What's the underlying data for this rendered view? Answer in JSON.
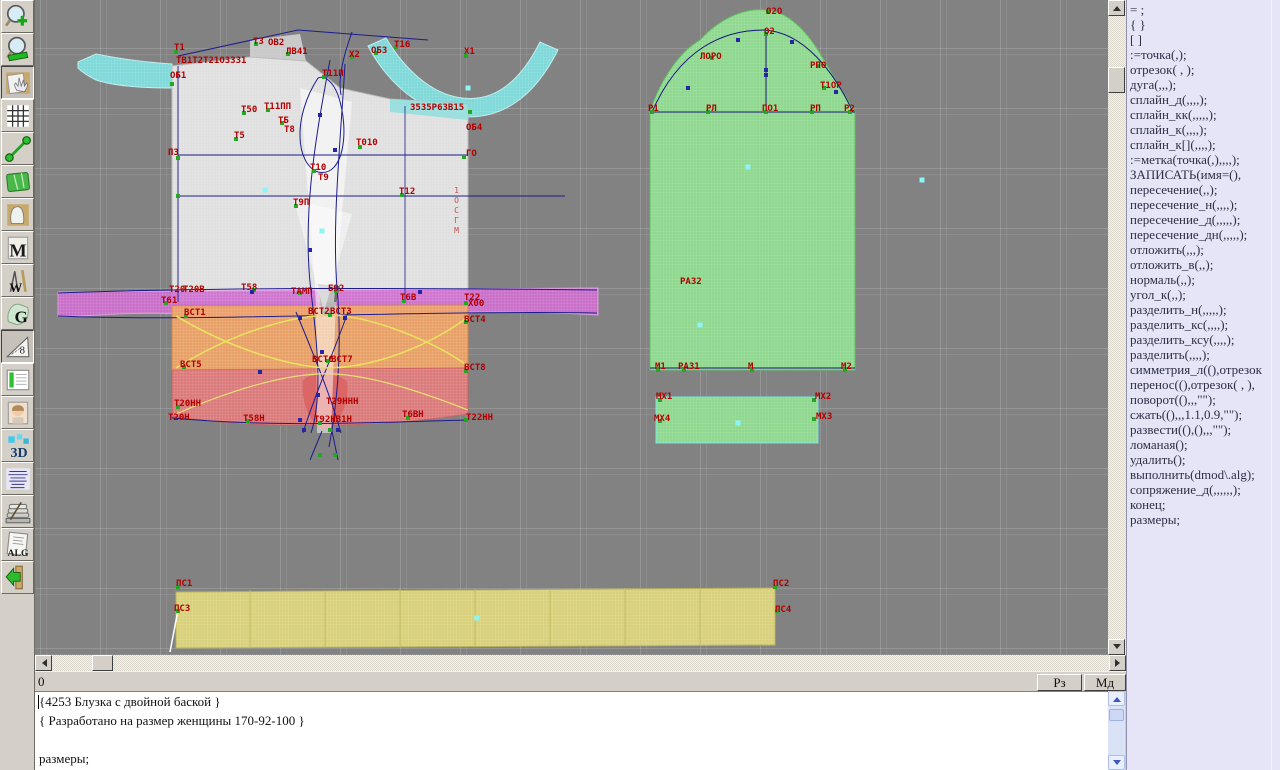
{
  "status": {
    "left": "0",
    "buttons": [
      "Рз",
      "Мд"
    ]
  },
  "editor": {
    "lines": [
      "{4253 Блузка с двойной баской }",
      "{ Разработано на размер женщины 170-92-100 }",
      "",
      "размеры;"
    ]
  },
  "command_panel": {
    "bg": "#e5e5f7",
    "items": [
      "= ;",
      "{ }",
      "[ ]",
      ":=точка(,);",
      "отрезок( , );",
      "дуга(,,,);",
      "сплайн_д(,,,,);",
      "сплайн_кк(,,,,,);",
      "сплайн_к(,,,,);",
      "сплайн_к[](,,,,);",
      ":=метка(точка(,),,,,);",
      "ЗАПИСАТЬ(имя=(),",
      "пересечение(,,);",
      "пересечение_н(,,,,);",
      "пересечение_д(,,,,,);",
      "пересечение_дн(,,,,,);",
      "отложить(,,,);",
      "отложить_в(,,);",
      "нормаль(,,);",
      "угол_к(,,);",
      "разделить_н(,,,,,);",
      "разделить_кс(,,,,);",
      "разделить_ксу(,,,,);",
      "разделить(,,,,);",
      "симметрия_л((),отрезок",
      "перенос((),отрезок( , ),",
      "поворот((),,,\"\");",
      "сжать((),,,1.1,0.9,\"\");",
      "развести((),(),,,\"\");",
      "ломаная();",
      "удалить();",
      "выполнить(dmod\\.alg);",
      "сопряжение_д(,,,,,,);",
      "конец;",
      "размеры;"
    ]
  },
  "toolbar": {
    "items": [
      {
        "id": "zoom-in",
        "glyph": "",
        "pressed": false
      },
      {
        "id": "zoom-out",
        "glyph": "",
        "pressed": false
      },
      {
        "id": "pan",
        "glyph": "",
        "pressed": true
      },
      {
        "id": "grid",
        "glyph": "",
        "pressed": false
      },
      {
        "id": "measure",
        "glyph": "",
        "pressed": false
      },
      {
        "id": "map",
        "glyph": "",
        "pressed": false
      },
      {
        "id": "pattern",
        "glyph": "",
        "pressed": false
      },
      {
        "id": "m-module",
        "glyph": "M",
        "pressed": false
      },
      {
        "id": "draw-tools",
        "glyph": "W",
        "pressed": false
      },
      {
        "id": "grace",
        "glyph": "G",
        "pressed": false
      },
      {
        "id": "ruler",
        "glyph": "8",
        "pressed": true
      },
      {
        "id": "table",
        "glyph": "",
        "pressed": false
      },
      {
        "id": "portrait",
        "glyph": "",
        "pressed": false
      },
      {
        "id": "view-3d",
        "glyph": "3D",
        "pressed": false
      },
      {
        "id": "list",
        "glyph": "",
        "pressed": false
      },
      {
        "id": "books",
        "glyph": "",
        "pressed": false
      },
      {
        "id": "alg",
        "glyph": "ALG",
        "pressed": false
      },
      {
        "id": "exit",
        "glyph": "",
        "pressed": false
      }
    ]
  },
  "canvas": {
    "bg": "#828282",
    "label_color": "#b20000",
    "vertical_label": {
      "text": "1ОСГМ",
      "x": 452,
      "y": 186
    },
    "labels": [
      [
        "Т1",
        174,
        44
      ],
      [
        "ТВ1Т2Т21ОЗЗЗ1",
        176,
        57
      ],
      [
        "ОБ1",
        170,
        72
      ],
      [
        "Т3",
        253,
        38
      ],
      [
        "ОВ2",
        268,
        39
      ],
      [
        "ЛВ41",
        286,
        48
      ],
      [
        "Х2",
        349,
        51
      ],
      [
        "ОБ3",
        371,
        47
      ],
      [
        "Т16",
        394,
        41
      ],
      [
        "Х1",
        464,
        48
      ],
      [
        "Т11П",
        322,
        70
      ],
      [
        "Т50",
        241,
        106
      ],
      [
        "Т11ПП",
        264,
        103
      ],
      [
        "ТБ",
        278,
        117
      ],
      [
        "Т8",
        284,
        126
      ],
      [
        "Т5",
        234,
        132
      ],
      [
        "З5З5Р6ЗВ15",
        410,
        104
      ],
      [
        "ОБ4",
        466,
        124
      ],
      [
        "ПЗ",
        168,
        149
      ],
      [
        "Т010",
        356,
        139
      ],
      [
        "ГО",
        466,
        150
      ],
      [
        "Т10",
        310,
        164
      ],
      [
        "Т9",
        318,
        174
      ],
      [
        "Т12",
        399,
        188
      ],
      [
        "Т9П",
        293,
        199
      ],
      [
        "Т20",
        169,
        286
      ],
      [
        "Т20В",
        183,
        286
      ],
      [
        "Т58",
        241,
        284
      ],
      [
        "ТАМП",
        291,
        288
      ],
      [
        "Б92",
        328,
        285
      ],
      [
        "Т6В",
        400,
        294
      ],
      [
        "Т22",
        464,
        294
      ],
      [
        "Х00",
        468,
        300
      ],
      [
        "Т61",
        161,
        297
      ],
      [
        "ВСТ1",
        184,
        309
      ],
      [
        "ВСТ2",
        308,
        308
      ],
      [
        "ВСТ3",
        330,
        308
      ],
      [
        "ВСТ4",
        464,
        316
      ],
      [
        "ВСТ5",
        180,
        361
      ],
      [
        "ВСТ6",
        312,
        356
      ],
      [
        "ВСТ7",
        331,
        356
      ],
      [
        "ВСТ8",
        464,
        364
      ],
      [
        "Т20НН",
        174,
        400
      ],
      [
        "Т29ННН",
        326,
        398
      ],
      [
        "Т20Н",
        168,
        414
      ],
      [
        "Т58Н",
        243,
        415
      ],
      [
        "Т92НВ1Н",
        314,
        416
      ],
      [
        "Т6ВН",
        402,
        411
      ],
      [
        "Т22НН",
        466,
        414
      ],
      [
        "О2О",
        766,
        8
      ],
      [
        "О2",
        764,
        28
      ],
      [
        "ЛОРО",
        700,
        53
      ],
      [
        "РПО",
        810,
        62
      ],
      [
        "Т1ОР",
        820,
        82
      ],
      [
        "Р1",
        648,
        105
      ],
      [
        "РЛ",
        706,
        105
      ],
      [
        "ПО1",
        762,
        105
      ],
      [
        "РП",
        810,
        105
      ],
      [
        "Р2",
        844,
        105
      ],
      [
        "РА32",
        680,
        278
      ],
      [
        "М1",
        655,
        363
      ],
      [
        "РА31",
        678,
        363
      ],
      [
        "М",
        748,
        363
      ],
      [
        "М2",
        841,
        363
      ],
      [
        "МХ1",
        656,
        393
      ],
      [
        "МХ2",
        815,
        393
      ],
      [
        "МХ4",
        654,
        415
      ],
      [
        "МХ3",
        816,
        413
      ],
      [
        "ПС1",
        176,
        580
      ],
      [
        "ПС2",
        773,
        580
      ],
      [
        "ПС3",
        174,
        605
      ],
      [
        "ПС4",
        775,
        606
      ]
    ],
    "points": [
      [
        176,
        52
      ],
      [
        172,
        84
      ],
      [
        256,
        44
      ],
      [
        288,
        54
      ],
      [
        352,
        57
      ],
      [
        376,
        53
      ],
      [
        396,
        47
      ],
      [
        466,
        56
      ],
      [
        324,
        77
      ],
      [
        244,
        113
      ],
      [
        268,
        110
      ],
      [
        282,
        123
      ],
      [
        236,
        139
      ],
      [
        470,
        112
      ],
      [
        360,
        147
      ],
      [
        464,
        157
      ],
      [
        314,
        171
      ],
      [
        402,
        195
      ],
      [
        296,
        206
      ],
      [
        178,
        158
      ],
      [
        178,
        196
      ],
      [
        254,
        290
      ],
      [
        300,
        293
      ],
      [
        336,
        291
      ],
      [
        404,
        301
      ],
      [
        466,
        303
      ],
      [
        166,
        303
      ],
      [
        186,
        316
      ],
      [
        330,
        315
      ],
      [
        466,
        322
      ],
      [
        184,
        367
      ],
      [
        328,
        361
      ],
      [
        466,
        371
      ],
      [
        178,
        407
      ],
      [
        248,
        421
      ],
      [
        320,
        423
      ],
      [
        408,
        418
      ],
      [
        466,
        420
      ],
      [
        178,
        587
      ],
      [
        775,
        587
      ],
      [
        178,
        611
      ],
      [
        777,
        611
      ],
      [
        652,
        112
      ],
      [
        708,
        112
      ],
      [
        766,
        112
      ],
      [
        812,
        112
      ],
      [
        850,
        112
      ],
      [
        712,
        58
      ],
      [
        766,
        34
      ],
      [
        818,
        66
      ],
      [
        824,
        88
      ],
      [
        768,
        12
      ],
      [
        658,
        370
      ],
      [
        684,
        370
      ],
      [
        752,
        370
      ],
      [
        845,
        370
      ],
      [
        660,
        400
      ],
      [
        814,
        400
      ],
      [
        660,
        421
      ],
      [
        814,
        419
      ],
      [
        330,
        430
      ],
      [
        320,
        455
      ],
      [
        335,
        455
      ]
    ],
    "cyan_dots": [
      [
        468,
        88
      ],
      [
        265,
        190
      ],
      [
        322,
        231
      ],
      [
        748,
        167
      ],
      [
        700,
        325
      ],
      [
        477,
        618
      ],
      [
        738,
        423
      ],
      [
        922,
        180
      ]
    ],
    "navy_markers": [
      [
        766,
        70
      ],
      [
        738,
        40
      ],
      [
        792,
        42
      ],
      [
        688,
        88
      ],
      [
        836,
        92
      ],
      [
        320,
        115
      ],
      [
        335,
        150
      ],
      [
        310,
        250
      ],
      [
        322,
        352
      ],
      [
        318,
        395
      ],
      [
        252,
        292
      ],
      [
        420,
        292
      ],
      [
        304,
        430
      ],
      [
        338,
        430
      ],
      [
        300,
        318
      ],
      [
        345,
        318
      ],
      [
        260,
        372
      ],
      [
        300,
        420
      ],
      [
        766,
        75
      ]
    ],
    "shapes": [
      {
        "d": "M78,62 L96,54 Q130,61 172,64 L172,88 Q120,88 96,80 Q84,74 78,68 Z",
        "f": "#7fd9d9",
        "s": "#bfecec",
        "m": true
      },
      {
        "d": "M368,46 C388,84 420,110 456,116 C500,122 534,98 558,50 L540,42 C520,82 494,102 462,98 C430,94 404,68 386,38 Z",
        "f": "#7fd9d9",
        "s": "#bfecec",
        "m": true
      },
      {
        "d": "M250,40 L300,34 L306,61 L250,57 Z",
        "f": "#e8e8e8",
        "o": 0.7
      },
      {
        "d": "M172,66 L250,57 L306,61 L340,88 L390,99 L468,104 L468,302 L172,302 Z",
        "f": "#e4e4e4",
        "s": "#bdbdbd",
        "m": true,
        "o": 0.96
      },
      {
        "d": "M390,99 L468,104 L468,120 L390,112 Z",
        "f": "#8fdede",
        "o": 0.85
      },
      {
        "d": "M58,292 L598,288 L598,315 C460,306 310,320 180,314 C120,311 84,318 58,316 Z",
        "f": "#cf6ecf",
        "s": "#e2a0e2",
        "m": true,
        "o": 0.93
      },
      {
        "d": "M172,306 L468,305 L468,370 L172,372 Z",
        "f": "#eea266",
        "s": "#d88848",
        "m": true,
        "o": 0.95
      },
      {
        "d": "M172,370 L468,368 L468,414 C380,428 260,430 172,416 Z",
        "f": "#e27a7a",
        "s": "#c86060",
        "m": true,
        "o": 0.93
      },
      {
        "d": "M303,380 C310,372 340,372 347,382 C350,400 340,426 325,430 C310,426 300,400 303,380 Z",
        "f": "#d86262",
        "o": 0.85
      },
      {
        "d": "M318,284 L340,286 L333,316 L322,316 Z",
        "f": "#6f6f6f"
      },
      {
        "d": "M300,88 L352,102 L334,302 L316,302 Z",
        "f": "#ffffff",
        "o": 0.55
      },
      {
        "d": "M294,200 L352,214 L324,312 Z",
        "f": "#ffffff",
        "o": 0.45
      },
      {
        "d": "M316,302 L336,302 L331,433 L317,433 Z",
        "f": "#ffffff",
        "o": 0.5
      },
      {
        "d": "M650,112 C658,86 676,54 700,40 C724,14 750,8 766,10 C792,12 812,38 826,64 C838,84 848,100 855,112 L855,370 L650,370 Z",
        "f": "#8fd88f",
        "s": "#5fc05f",
        "m": true
      },
      {
        "d": "M656,397 L818,397 L818,443 L656,443 Z",
        "f": "#8fd88f",
        "s": "#70e8e8",
        "m": true
      },
      {
        "d": "M176,592 L775,588 L775,645 L176,648 Z",
        "f": "#d8d07a",
        "s": "#b8b058",
        "m": true
      },
      {
        "d": "M250,590 V647 M325,590 V647 M400,589 V646 M475,589 V646 M550,589 V646 M625,588 V646 M700,588 V645",
        "s": "#c2ba60"
      },
      {
        "d": "M178,56 L298,30 L428,40",
        "s": "#1c1c8e"
      },
      {
        "d": "M318,78 C292,118 296,164 318,172 C344,178 350,130 338,95 C333,82 325,75 318,78",
        "s": "#1c1c8e"
      },
      {
        "d": "M330,60 C315,140 301,220 312,300 C318,350 322,400 311,433",
        "s": "#1c1c8e"
      },
      {
        "d": "M345,64 C340,150 331,230 338,300 C342,360 336,410 329,447",
        "s": "#1c1c8e"
      },
      {
        "d": "M352,32 C342,60 338,80 341,95",
        "s": "#1c1c8e"
      },
      {
        "d": "M178,155 L468,155",
        "s": "#1c1c8e"
      },
      {
        "d": "M178,196 L565,196",
        "s": "#1c1c8e"
      },
      {
        "d": "M178,66 L178,302",
        "s": "#28288a"
      },
      {
        "d": "M405,106 L405,300",
        "s": "#1c1c8e",
        "w": 0.8
      },
      {
        "d": "M58,293 C220,287 420,288 597,290",
        "s": "#1c1c8e"
      },
      {
        "d": "M58,316 C200,322 420,310 597,313",
        "s": "#1c1c8e"
      },
      {
        "d": "M296,312 C316,360 332,400 341,433",
        "s": "#1c1c8e"
      },
      {
        "d": "M348,312 C330,362 312,402 303,433",
        "s": "#1c1c8e"
      },
      {
        "d": "M176,368 C240,328 300,315 332,315 C372,317 432,340 468,366",
        "s": "#eae060",
        "w": 1.6
      },
      {
        "d": "M176,316 C240,354 300,368 332,368 C380,366 432,344 468,317",
        "s": "#eae060",
        "w": 1.6
      },
      {
        "d": "M176,414 C250,382 300,372 336,374 C380,377 432,396 468,410",
        "s": "#e8e070",
        "w": 1.2
      },
      {
        "d": "M172,418 C280,428 380,422 468,420",
        "s": "#1c1c8e"
      },
      {
        "d": "M322,431 L310,460",
        "s": "#1c1c8e"
      },
      {
        "d": "M332,431 L338,460",
        "s": "#1c1c8e"
      },
      {
        "d": "M652,112 C680,48 724,30 764,30 C804,32 834,72 853,112",
        "s": "#15157e"
      },
      {
        "d": "M766,32 L766,112",
        "s": "#15157e"
      },
      {
        "d": "M650,112 L855,112",
        "s": "#15157e"
      },
      {
        "d": "M650,368 L855,368",
        "s": "#15157e"
      },
      {
        "d": "M178,610 L170,652",
        "s": "#ffffff",
        "w": 1.5
      }
    ]
  }
}
